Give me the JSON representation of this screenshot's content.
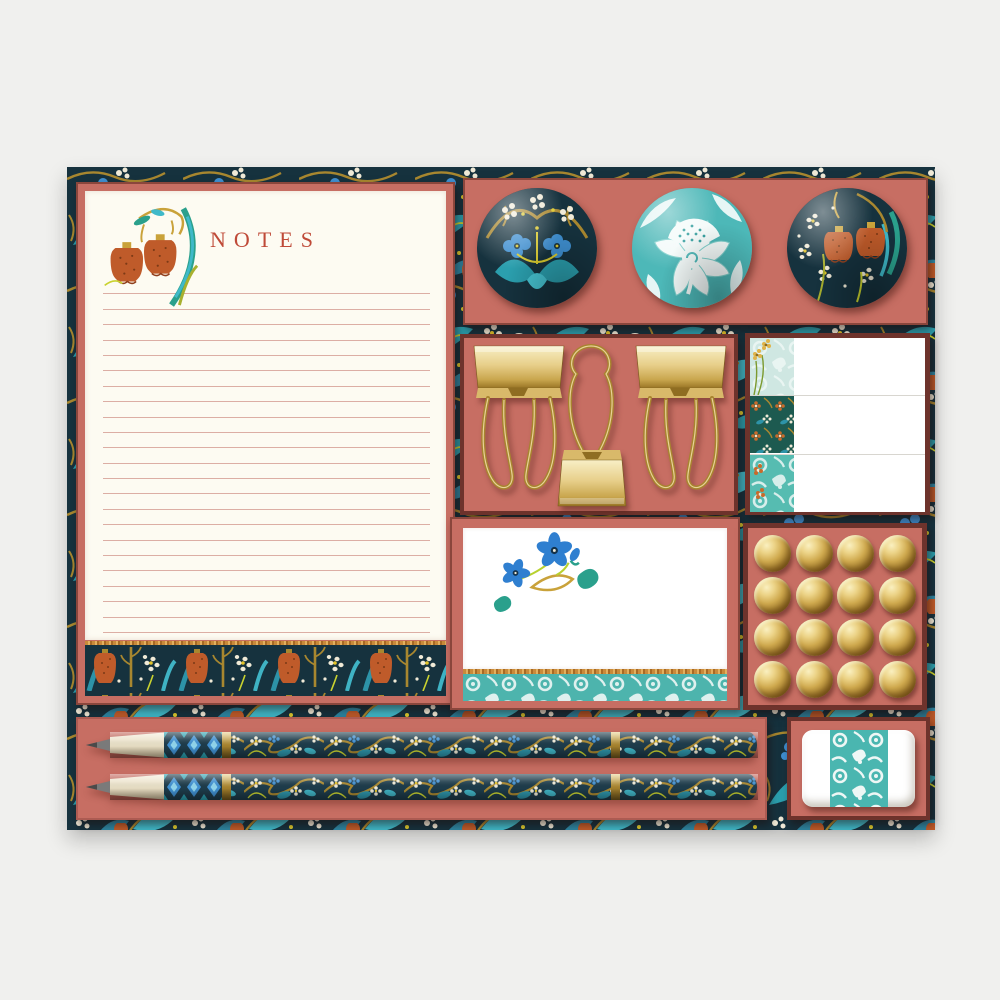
{
  "scene": {
    "description": "William Morris style floral stationery gift set flat lay",
    "background_color": "#f0f0ee",
    "mat_base_color": "#16323e",
    "panel_color": "#c76e63",
    "panel_border_color": "#6e332c"
  },
  "notepad": {
    "title": "NOTES",
    "title_color": "#bf4a38",
    "paper_color": "#fdfbf2",
    "ruled_line_count": 25,
    "line_color": "#c67b70",
    "corner_motif": "orange-fritillary-sprig",
    "footer_motif": "tulip-and-daisy-frieze"
  },
  "magnets": {
    "count": 3,
    "items": [
      {
        "name": "navy-blue-floral-magnet",
        "base_color": "#16323e"
      },
      {
        "name": "teal-white-peony-magnet",
        "base_color": "#4db8b8"
      },
      {
        "name": "navy-orange-fritillary-magnet",
        "base_color": "#16323e"
      }
    ]
  },
  "binder_clips": {
    "count": 3,
    "finish": "gold",
    "orientations": [
      "handles-down",
      "handle-up",
      "handles-down"
    ]
  },
  "sticky_notes": {
    "count": 3,
    "edge_patterns": [
      "light-teal-damask-gold-flowers",
      "dark-teal-floral",
      "teal-damask-orange-flowers"
    ]
  },
  "note_card": {
    "paper_color": "#ffffff",
    "motif": "blue-flower-sprig",
    "footer_band": "teal-damask"
  },
  "push_pins": {
    "count": 16,
    "rows": 4,
    "cols": 4,
    "finish": "gold"
  },
  "pencils": {
    "count": 2,
    "style": "navy-morris-floral",
    "tip": "sharpened",
    "bands": "gold"
  },
  "eraser": {
    "count": 1,
    "body_color": "#ffffff",
    "band_pattern": "teal-damask",
    "band_color": "#4ab6b0"
  }
}
